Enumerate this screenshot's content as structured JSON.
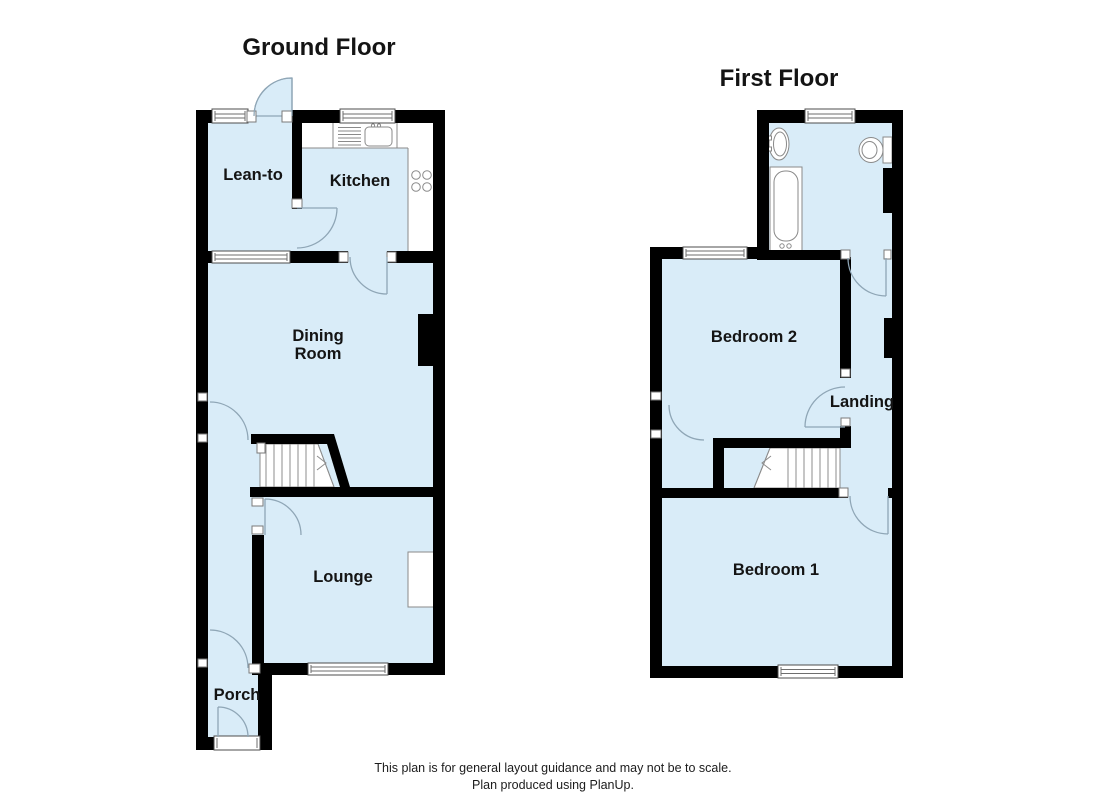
{
  "colors": {
    "floor": "#d9ecf8",
    "wall": "#000000",
    "door": "#8fa6b6",
    "fixture": "#8a8a8a"
  },
  "ground_floor": {
    "title": "Ground Floor",
    "rooms": {
      "lean_to": "Lean-to",
      "kitchen": "Kitchen",
      "dining_line1": "Dining",
      "dining_line2": "Room",
      "lounge": "Lounge",
      "porch": "Porch"
    }
  },
  "first_floor": {
    "title": "First Floor",
    "rooms": {
      "bedroom2": "Bedroom 2",
      "landing": "Landing",
      "bedroom1": "Bedroom 1"
    }
  },
  "footer": {
    "line1": "This plan is for general layout guidance and may not be to scale.",
    "line2": "Plan produced using PlanUp."
  }
}
